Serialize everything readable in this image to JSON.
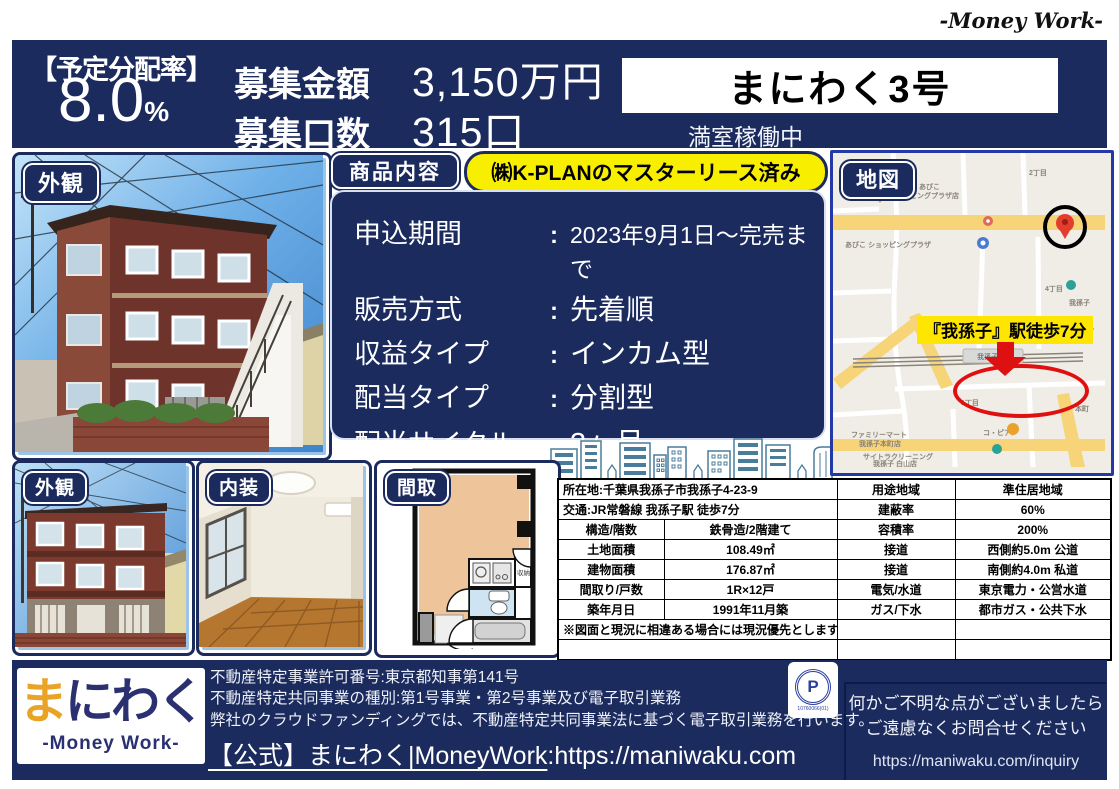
{
  "brand": {
    "script_name": "-Money Work-"
  },
  "separator": ":",
  "header": {
    "rate_label": "【予定分配率】",
    "rate_value": "8.0",
    "rate_unit": "%",
    "offer_amount_label": "募集金額",
    "offer_amount_value": "3,150万円",
    "offer_units_label": "募集口数",
    "offer_units_value": "315口",
    "product_name": "まにわく3号",
    "occupancy_status": "満室稼働中"
  },
  "photos": {
    "exterior_main_label": "外観",
    "exterior_sub_label": "外観",
    "interior_label": "内装",
    "floorplan_label": "間取",
    "floorplan_closet": "収納"
  },
  "product": {
    "section_label": "商品内容",
    "highlight": "㈱K-PLANのマスターリース済み",
    "rows": [
      {
        "label": "申込期間",
        "value": "2023年9月1日〜完売まで"
      },
      {
        "label": "販売方式",
        "value": "先着順"
      },
      {
        "label": "収益タイプ",
        "value": "インカム型"
      },
      {
        "label": "配当タイプ",
        "value": "分割型"
      },
      {
        "label": "配当サイクル",
        "value": "3ヶ月"
      },
      {
        "label": "運用期間",
        "value": "R5年10月1日〜R6年9月31日"
      }
    ]
  },
  "map": {
    "section_label": "地図",
    "station_flag": "『我孫子』駅徒歩7分",
    "labels": {
      "kura_l1": "くら寿司 あびこ",
      "kura_l2": "ショッピングプラザ店",
      "abiko_plaza": "あびこ ショッピングプラザ",
      "chome2": "2丁目",
      "chome4": "4丁目",
      "abiko_town": "我孫子",
      "station_name": "我孫子",
      "jr": "JR",
      "chome1": "1丁目",
      "honcho": "本町",
      "copian": "コ・ピアン",
      "famima_ekimae_l1": "ファミリーマート",
      "famima_ekimae_l2": "我孫子駅前店",
      "famima_honcho_l1": "ファミリーマート",
      "famima_honcho_l2": "我孫子本町店",
      "cleaning_l1": "サイトラクリーニング",
      "cleaning_l2": "我孫子 白山店"
    }
  },
  "table": {
    "r1": {
      "c12": "所在地:千葉県我孫子市我孫子4-23-9",
      "c3": "用途地域",
      "c4": "準住居地域"
    },
    "r2": {
      "c12": "交通:JR常磐線 我孫子駅 徒歩7分",
      "c3": "建蔽率",
      "c4": "60%"
    },
    "r3": {
      "c1": "構造/階数",
      "c2": "鉄骨造/2階建て",
      "c3": "容積率",
      "c4": "200%"
    },
    "r4": {
      "c1": "土地面積",
      "c2": "108.49㎡",
      "c3": "接道",
      "c4": "西側約5.0m 公道"
    },
    "r5": {
      "c1": "建物面積",
      "c2": "176.87㎡",
      "c3": "接道",
      "c4": "南側約4.0m 私道"
    },
    "r6": {
      "c1": "間取り/戸数",
      "c2": "1R×12戸",
      "c3": "電気/水道",
      "c4": "東京電力・公営水道"
    },
    "r7": {
      "c1": "築年月日",
      "c2": "1991年11月築",
      "c3": "ガス/下水",
      "c4": "都市ガス・公共下水"
    },
    "r8": {
      "c12": "※図面と現況に相違ある場合には現況優先とします。"
    }
  },
  "footer": {
    "logo_ma": "ま",
    "logo_rest": "にわく",
    "logo_sub": "-Money Work-",
    "reg_line1": "不動産特定事業許可番号:東京都知事第141号",
    "reg_line2": "不動産特定共同事業の種別:第1号事業・第2号事業及び電子取引業務",
    "reg_line3": "弊社のクラウドファンディングでは、不動産特定共同事業法に基づく電子取引業務を行います。",
    "official_label": "【公式】まにわく|MoneyWork",
    "official_url": ":https://maniwaku.com",
    "pmark_letter": "P",
    "pmark_number": "10760066(01)",
    "inquiry_line1": "何かご不明な点がございましたら",
    "inquiry_line2": "ご遠慮なくお問合せください",
    "inquiry_url": "https://maniwaku.com/inquiry"
  },
  "colors": {
    "navy": "#1b2b5e",
    "yellow_pill": "#f7ee00",
    "map_flag_yellow": "#ffe600",
    "accent_red": "#dd1111",
    "logo_orange": "#e9a426"
  }
}
